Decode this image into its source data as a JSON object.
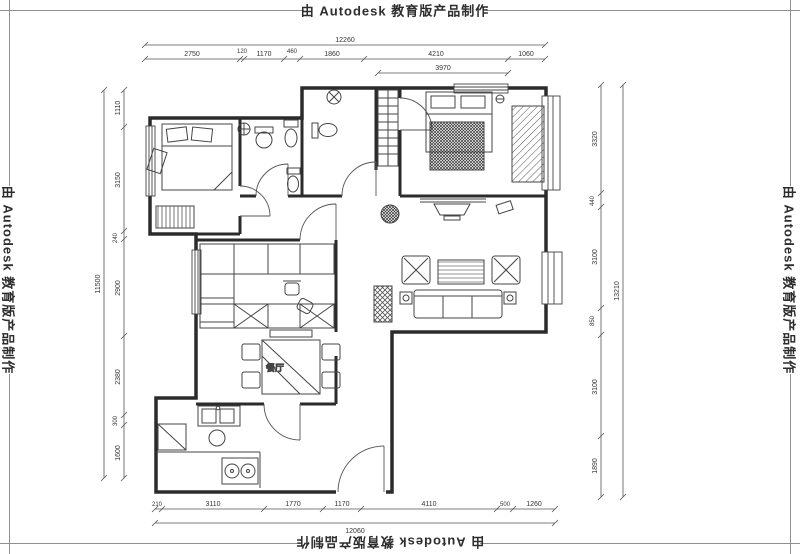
{
  "watermark": {
    "text": "由 Autodesk 教育版产品制作"
  },
  "plan": {
    "dining_label": "餐厅"
  },
  "dims": {
    "top": {
      "overall": "12260",
      "sub": "3970",
      "segments": [
        "2750",
        "120",
        "1170",
        "460",
        "1860",
        "4210",
        "1060"
      ]
    },
    "bottom": {
      "overall": "12060",
      "segments": [
        "210",
        "3110",
        "1770",
        "1170",
        "4110",
        "500",
        "1260"
      ]
    },
    "left": {
      "overall": "11500",
      "segments": [
        "1110",
        "3150",
        "240",
        "2900",
        "2380",
        "300",
        "1600"
      ]
    },
    "right": {
      "overall": "13210",
      "segments": [
        "3320",
        "440",
        "3100",
        "850",
        "3100",
        "1890"
      ]
    }
  },
  "colors": {
    "ink": "#2b2b2b",
    "furniture": "#444444",
    "dimension": "#555555",
    "paper": "#ffffff"
  }
}
